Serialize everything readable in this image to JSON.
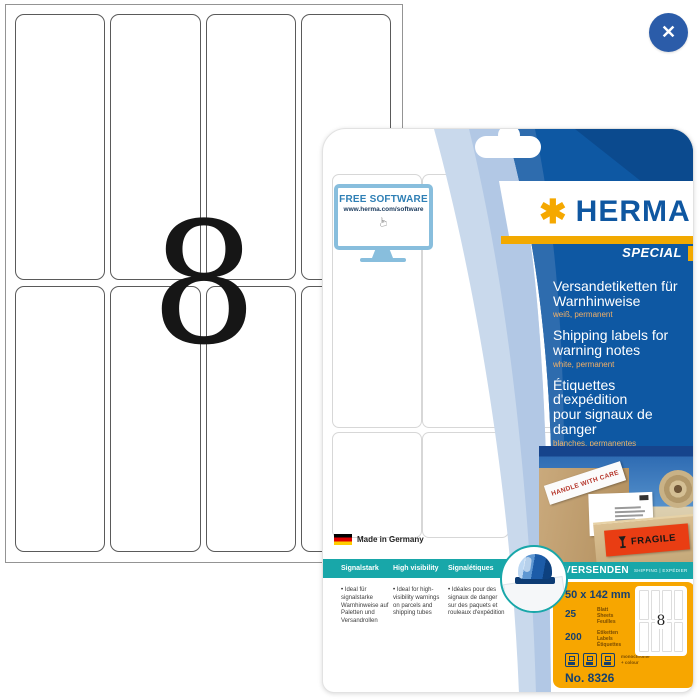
{
  "viewer": {
    "close_label": "✕"
  },
  "sheet_diagram": {
    "count": "8"
  },
  "package": {
    "free_software": {
      "title": "FREE SOFTWARE",
      "url": "www.herma.com/software",
      "cursor": "☞"
    },
    "brand": {
      "asterisk": "✱",
      "name": "HERMA",
      "badge": "SPECIAL"
    },
    "titles": {
      "de": {
        "lines": [
          "Versandetiketten für",
          "Warnhinweise"
        ],
        "subtitle": "weiß, permanent"
      },
      "en": {
        "lines": [
          "Shipping labels for",
          "warning notes"
        ],
        "subtitle": "white, permanent"
      },
      "fr": {
        "lines": [
          "Étiquettes d'expédition",
          "pour signaux de",
          "danger"
        ],
        "subtitle": "blanches, permanentes"
      }
    },
    "photo_labels": {
      "handle": "HANDLE WITH CARE",
      "fragile": "FRAGILE"
    },
    "made_in": "Made in Germany",
    "features": [
      {
        "header": "Signalstark",
        "text": "Ideal für signalstarke Warnhinweise auf Paletten und Versandrollen"
      },
      {
        "header": "High visibility",
        "text": "Ideal for high-visibility warnings on parcels and shipping tubes"
      },
      {
        "header": "Signalétiques",
        "text": "Idéales pour des signaux de danger sur des paquets et rouleaux d'expédition"
      }
    ],
    "category": {
      "main": "VERSENDEN",
      "sub": "SHIPPING | EXPÉDIER"
    },
    "specs": {
      "size": "50 x 142 mm",
      "sheets": {
        "count": "25",
        "units": [
          "Blatt",
          "Sheets",
          "Feuilles"
        ]
      },
      "labels": {
        "count": "200",
        "units": [
          "Etiketten",
          "Labels",
          "Étiquettes"
        ]
      },
      "print_note": [
        "monochrome",
        "+ colour"
      ],
      "article_no": "No. 8326",
      "mini_count": "8"
    },
    "colors": {
      "herma_blue": "#0E58A3",
      "herma_orange": "#F5A800",
      "teal": "#18A7A9",
      "panel_orange": "#F7A600"
    }
  }
}
